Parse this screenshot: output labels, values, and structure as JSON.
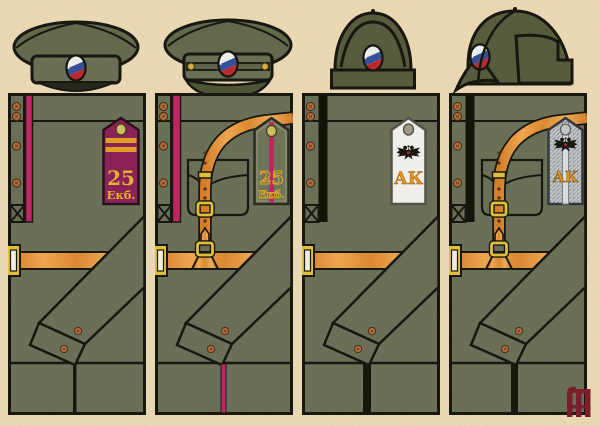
{
  "plate": {
    "background_color": "#eddcb6",
    "palette": {
      "tunic_olive": "#6a7158",
      "cap_olive_dark": "#585c3d",
      "outline_black": "#16160f",
      "crimson_piping": "#c32467",
      "board_crimson": "#8c2158",
      "leather_orange": "#e0862f",
      "brass_yellow": "#e3c33c",
      "gold_lettering": "#e0a42c",
      "copper_button": "#b5713f",
      "board_white": "#f4f3ee",
      "board_silver": "#b0b4b8",
      "cockade_white": "#f2f2ee",
      "cockade_blue": "#35509c",
      "cockade_red": "#c0272d",
      "logo_maroon": "#7b1d2b"
    },
    "caps": [
      {
        "name": "peaked-field-cap-front",
        "badge": "tricolor-cockade"
      },
      {
        "name": "peaked-cap-with-chinstrap-front",
        "badge": "tricolor-cockade"
      },
      {
        "name": "cloth-helmet-front",
        "badge": "tricolor-cockade"
      },
      {
        "name": "cloth-helmet-side",
        "badge": "tricolor-cockade"
      }
    ],
    "uniforms": [
      {
        "piping": "crimson",
        "board": {
          "field": "crimson",
          "number": "25",
          "abbr": "Екб."
        }
      },
      {
        "piping": "crimson",
        "board": {
          "field": "khaki",
          "number": "25",
          "abbr": "Екб."
        }
      },
      {
        "piping": "black",
        "board": {
          "field": "white",
          "emblem": "double-headed-eagle",
          "monogram": "АК"
        }
      },
      {
        "piping": "black",
        "board": {
          "field": "silver-braid",
          "emblem": "double-headed-eagle",
          "monogram": "АК"
        }
      }
    ]
  }
}
